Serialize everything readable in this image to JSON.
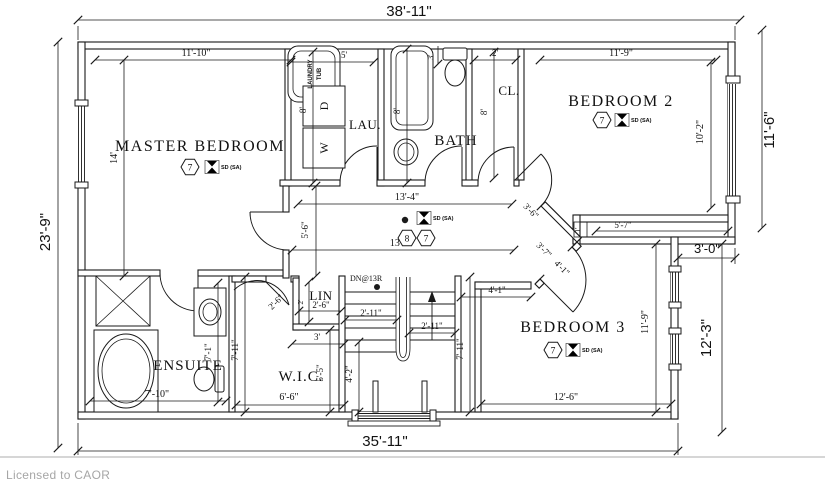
{
  "footer": {
    "license_text": "Licensed to CAOR"
  },
  "rooms": {
    "master_bedroom": "MASTER BEDROOM",
    "bedroom_2": "BEDROOM 2",
    "bedroom_3": "BEDROOM 3",
    "ensuite": "ENSUITE",
    "walk_in_closet": "W.I.C.",
    "laundry": "LAU.",
    "bath": "BATH",
    "closet": "CL.",
    "linen": "LIN"
  },
  "fixtures": {
    "laundry_tub_top": "LAUNDRY",
    "laundry_tub_bottom": "TUB",
    "dryer": "D",
    "washer": "W"
  },
  "stairs": {
    "down_label": "DN@13R"
  },
  "symbols": {
    "smoke_detector": "SD (SA)",
    "hex_7": "7",
    "hex_8": "8"
  },
  "dims": {
    "overall_width": "38'-11\"",
    "overall_depth": "23'-9\"",
    "bed2_depth_ext": "11'-6\"",
    "wall_jog": "3'-0\"",
    "bed3_depth_ext": "12'-3\"",
    "lower_width": "35'-11\"",
    "mb_width": "11'-10\"",
    "mb_depth": "14'",
    "laundry_width": "5'",
    "laundry_depth": "8'",
    "bath_depth": "8'",
    "bath_top": "3'",
    "closet_width": "2'",
    "closet_depth": "8'",
    "bed2_width": "11'-9\"",
    "bed2_depth_int": "10'-2\"",
    "hall_upper": "13'-4\"",
    "hall_lower": "13'-7\"",
    "hall_width": "5'-6\"",
    "bed2_door": "3'-6\"",
    "angled_wall": "3'-7\"",
    "bed3_door": "4'-1\"",
    "wall_sliver": "1'",
    "bed2_bottom": "5'-7\"",
    "bed3_top": "4'-1\"",
    "stair_side": "7'-11\"",
    "bed3_depth_int": "11'-9\"",
    "bed3_width": "12'-6\"",
    "linen_width": "2'-6\"",
    "linen_depth": "2'",
    "wic_door": "2'-6\"",
    "wic_opening": "3'",
    "wic_width": "6'-6\"",
    "wic_depth": "5'-5\"",
    "ensuite_width": "7'-10\"",
    "ensuite_depth_1": "7'-1\"",
    "ensuite_depth_2": "7'-11\"",
    "stair_upper_flight": "2'-11\"",
    "stair_lower_flight": "2'-11\"",
    "stair_run": "4'-2\""
  }
}
